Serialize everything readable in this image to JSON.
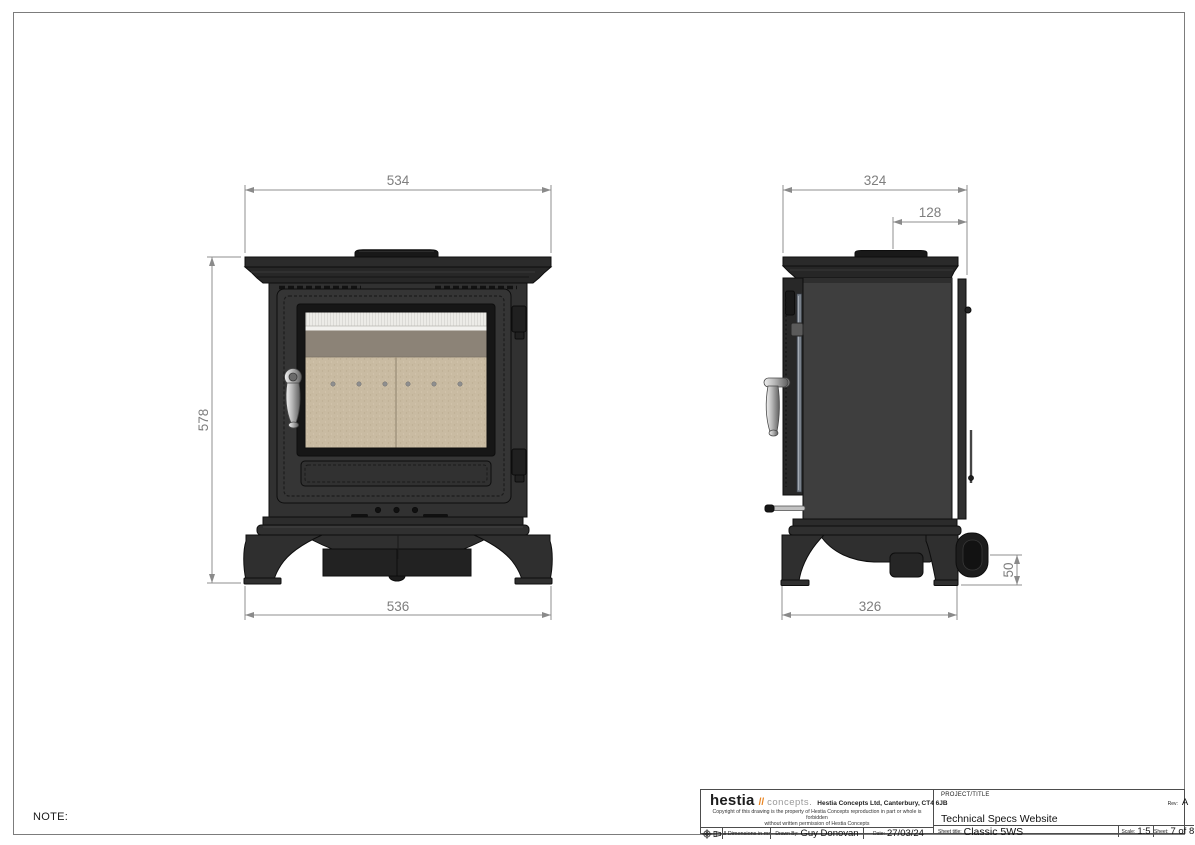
{
  "note_label": "NOTE:",
  "front_view": {
    "name": "front elevation of stove",
    "dim_width_top": "534",
    "dim_height": "578",
    "dim_width_base": "536"
  },
  "side_view": {
    "name": "side elevation of stove",
    "dim_depth_top": "324",
    "dim_flue_offset": "128",
    "dim_depth_base": "326",
    "dim_outlet_height": "50"
  },
  "title_block": {
    "logo": {
      "brand": "hestia",
      "slashes": "//",
      "suffix": "concepts.",
      "address": "Hestia Concepts Ltd, Canterbury, CT4 6JB"
    },
    "copyright_line1": "Copyright of this drawing is the property of Hestia Concepts reproduction in part or whole is forbidden",
    "copyright_line2": "without written permission of Hestia Concepts",
    "projection_icon": "third-angle-projection-symbol",
    "dimensions_note": "All Dimensions in mm",
    "drawn_by_label": "Drawn By:",
    "drawn_by": "Guy Donovan",
    "date_label": "Date:",
    "date": "27/03/24",
    "project_label": "PROJECT/TITLE",
    "rev_label": "Rev:",
    "rev": "A",
    "project": "Technical Specs Website",
    "sheet_title_label": "Sheet title:",
    "sheet_title": "Classic 5WS",
    "scale_label": "Scale:",
    "scale": "1:5",
    "sheet_label": "Sheet:",
    "sheet": "7 of 8"
  },
  "colors": {
    "accent_orange": "#e8821e",
    "stove_body": "#2f2f2f",
    "side_panel": "#3e3e3e",
    "firebrick": "#c9bba2",
    "baffle_gray": "#8c8377",
    "dimension_gray": "#8a8a8a",
    "border_gray": "#7c7c7c"
  }
}
